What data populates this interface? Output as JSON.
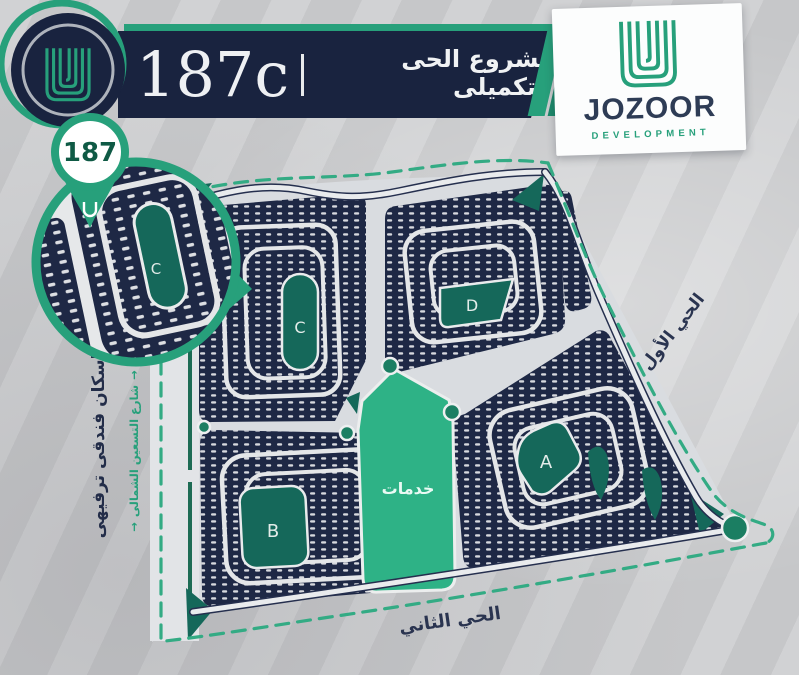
{
  "header": {
    "number": "187",
    "suffix": "c",
    "separator": "|",
    "title_ar": "مشروع الحى التكميلى"
  },
  "brand": {
    "name": "JOZOOR",
    "tagline": "DEVELOPMENT"
  },
  "inset": {
    "pin_number": "187",
    "zone_label": "C"
  },
  "map": {
    "services_label": "خدمات",
    "zones": [
      {
        "id": "A"
      },
      {
        "id": "B"
      },
      {
        "id": "C"
      },
      {
        "id": "D"
      }
    ],
    "labels": {
      "district_first": "الحي الأول",
      "district_second": "الحي الثاني",
      "housing": "إسكان فندقى ترفيهى",
      "street": "شارع التسعين الشمالى"
    },
    "icons": {
      "street_arrow": "→"
    }
  },
  "colors": {
    "navy": "#1e2845",
    "banner_navy": "#19233f",
    "teal": "#27a07b",
    "dark_teal": "#15685a",
    "services_green": "#2eb286",
    "background": "#c6c7c9"
  }
}
